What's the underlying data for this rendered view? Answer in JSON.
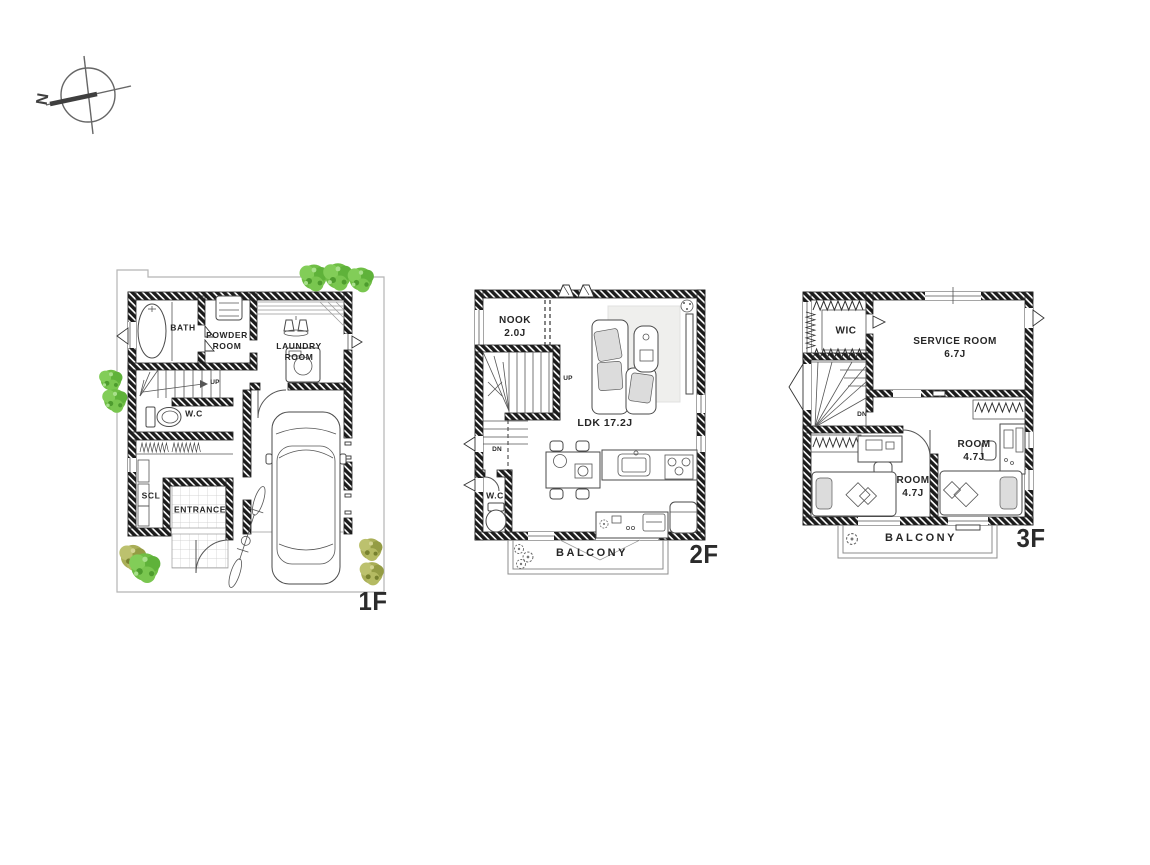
{
  "colors": {
    "ink": "#1e1e1e",
    "tree_green": "#6fbe45",
    "tree_olive": "#a9ae57",
    "site_line": "#b5b5b5",
    "balcony_line": "#8c8c8c"
  },
  "compass": {
    "north_label": "N"
  },
  "floors": {
    "f1": {
      "label": "1F",
      "rooms": {
        "bath": "BATH",
        "powder_room": "POWDER\nROOM",
        "laundry_room": "LAUNDRY\nROOM",
        "wc": "W.C",
        "scl": "SCL",
        "entrance": "ENTRANCE"
      },
      "stairs": {
        "up": "UP"
      }
    },
    "f2": {
      "label": "2F",
      "rooms": {
        "nook": "NOOK\n2.0J",
        "ldk": "LDK 17.2J",
        "wc": "W.C",
        "balcony": "BALCONY"
      },
      "stairs": {
        "up": "UP",
        "dn": "DN"
      }
    },
    "f3": {
      "label": "3F",
      "rooms": {
        "wic": "WIC",
        "service_room": "SERVICE ROOM\n6.7J",
        "room_a": "ROOM\n4.7J",
        "room_b": "ROOM\n4.7J",
        "balcony": "BALCONY"
      },
      "stairs": {
        "dn": "DN"
      }
    }
  }
}
